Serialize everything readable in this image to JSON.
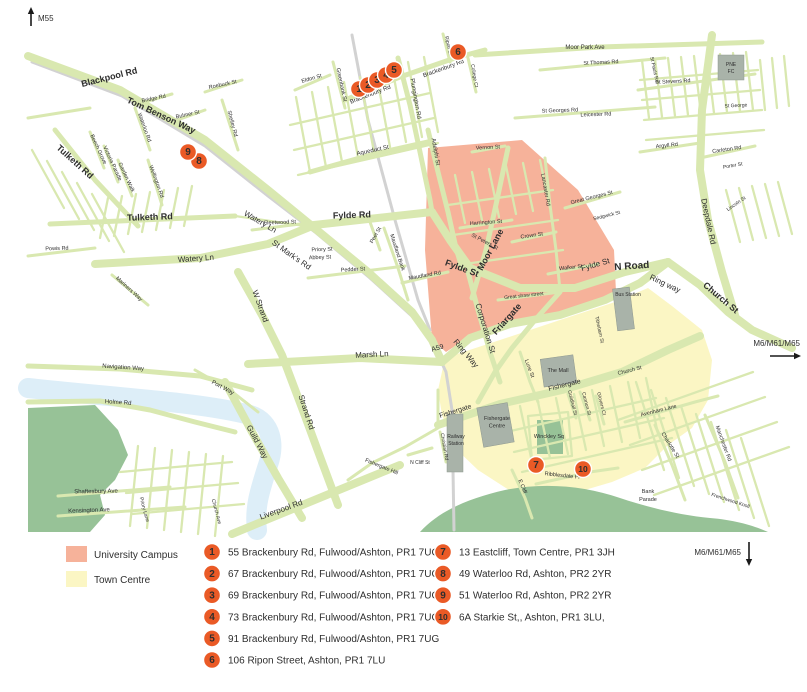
{
  "title": "Preston location map",
  "legend": {
    "swatches": [
      {
        "label": "University Campus",
        "color": "#f6b29a"
      },
      {
        "label": "Town Centre",
        "color": "#fbf6c4"
      }
    ],
    "entries": [
      {
        "num": "1",
        "col": 0,
        "text": "55 Brackenbury Rd, Fulwood/Ashton, PR1 7UG"
      },
      {
        "num": "2",
        "col": 0,
        "text": "67 Brackenbury Rd, Fulwood/Ashton, PR1 7UG"
      },
      {
        "num": "3",
        "col": 0,
        "text": "69 Brackenbury Rd, Fulwood/Ashton, PR1 7UG"
      },
      {
        "num": "4",
        "col": 0,
        "text": "73 Brackenbury Rd, Fulwood/Ashton, PR1 7UG"
      },
      {
        "num": "5",
        "col": 0,
        "text": "91 Brackenbury Rd, Fulwood/Ashton, PR1 7UG"
      },
      {
        "num": "6",
        "col": 0,
        "text": "106 Ripon Street, Ashton, PR1 7LU"
      },
      {
        "num": "7",
        "col": 1,
        "text": "13 Eastcliff, Town Centre, PR1 3JH"
      },
      {
        "num": "8",
        "col": 1,
        "text": "49 Waterloo Rd, Ashton, PR2 2YR"
      },
      {
        "num": "9",
        "col": 1,
        "text": "51 Waterloo Rd, Ashton, PR2 2YR"
      },
      {
        "num": "10",
        "col": 1,
        "text": "6A Starkie St,, Ashton, PR1 3LU,"
      }
    ]
  },
  "motorways": [
    {
      "label": "M55",
      "anchor": "start",
      "tx": 38,
      "ty": 21,
      "arrow": {
        "x1": 31,
        "y1": 26,
        "x2": 31,
        "y2": 7
      }
    },
    {
      "label": "M6/M61/M65",
      "anchor": "end",
      "tx": 800,
      "ty": 346,
      "arrow": {
        "x1": 770,
        "y1": 356,
        "x2": 801,
        "y2": 356
      }
    },
    {
      "label": "M6/M61/M65",
      "anchor": "end",
      "tx": 741,
      "ty": 555,
      "arrow": {
        "x1": 749,
        "y1": 542,
        "x2": 749,
        "y2": 566
      }
    }
  ],
  "map": {
    "marker_color": "#ea5a26",
    "markers": [
      {
        "num": "1",
        "x": 359,
        "y": 89
      },
      {
        "num": "2",
        "x": 368,
        "y": 85
      },
      {
        "num": "3",
        "x": 377,
        "y": 80
      },
      {
        "num": "4",
        "x": 386,
        "y": 75
      },
      {
        "num": "5",
        "x": 394,
        "y": 70
      },
      {
        "num": "6",
        "x": 458,
        "y": 52
      },
      {
        "num": "7",
        "x": 536,
        "y": 465
      },
      {
        "num": "8",
        "x": 199,
        "y": 161
      },
      {
        "num": "9",
        "x": 188,
        "y": 152
      },
      {
        "num": "10",
        "x": 583,
        "y": 469
      }
    ],
    "building_labels": [
      {
        "lines": [
          "PNE",
          "FC"
        ],
        "x": 731,
        "y": 66,
        "s": 5
      },
      {
        "lines": [
          "Bus Station"
        ],
        "x": 628,
        "y": 296,
        "s": 5
      },
      {
        "lines": [
          "The Mall"
        ],
        "x": 558,
        "y": 372,
        "s": 5.5
      },
      {
        "lines": [
          "Fishergate",
          "Centre"
        ],
        "x": 497,
        "y": 420,
        "s": 5.5
      },
      {
        "lines": [
          "Railway",
          "Station"
        ],
        "x": 456,
        "y": 438,
        "s": 5
      }
    ],
    "street_labels": [
      {
        "t": "Blackpool Rd",
        "x": 110,
        "y": 80,
        "r": -14,
        "s": 9
      },
      {
        "t": "Tom Benson Way",
        "x": 160,
        "y": 118,
        "r": 25,
        "s": 9
      },
      {
        "t": "Tulketh Rd",
        "x": 73,
        "y": 164,
        "r": 42,
        "s": 9
      },
      {
        "t": "Tulketh Rd",
        "x": 150,
        "y": 220,
        "r": -2,
        "s": 9
      },
      {
        "t": "Watery Ln",
        "x": 196,
        "y": 261,
        "r": -4,
        "s": 8
      },
      {
        "t": "Watery Ln",
        "x": 259,
        "y": 224,
        "r": 30,
        "s": 8
      },
      {
        "t": "St Mark's Rd",
        "x": 290,
        "y": 257,
        "r": 35,
        "s": 8
      },
      {
        "t": "W Strand",
        "x": 258,
        "y": 307,
        "r": 70,
        "s": 8
      },
      {
        "t": "Strand Rd",
        "x": 304,
        "y": 413,
        "r": 72,
        "s": 8
      },
      {
        "t": "Guild Way",
        "x": 255,
        "y": 443,
        "r": 62,
        "s": 8
      },
      {
        "t": "Liverpool Rd",
        "x": 282,
        "y": 512,
        "r": -20,
        "s": 8
      },
      {
        "t": "Marsh Ln",
        "x": 372,
        "y": 357,
        "r": -3,
        "s": 8
      },
      {
        "t": "A59",
        "x": 438,
        "y": 350,
        "r": -15,
        "s": 7
      },
      {
        "t": "Ring Way",
        "x": 464,
        "y": 355,
        "r": 50,
        "s": 8
      },
      {
        "t": "Ring way",
        "x": 664,
        "y": 286,
        "r": 25,
        "s": 8
      },
      {
        "t": "Fylde Rd",
        "x": 352,
        "y": 218,
        "r": -2,
        "s": 9
      },
      {
        "t": "Fylde St",
        "x": 461,
        "y": 271,
        "r": 20,
        "s": 9
      },
      {
        "t": "Fylde St",
        "x": 596,
        "y": 267,
        "r": -16,
        "s": 8
      },
      {
        "t": "N Road",
        "x": 632,
        "y": 269,
        "r": -4,
        "s": 10
      },
      {
        "t": "Moor Lane",
        "x": 493,
        "y": 251,
        "r": -62,
        "s": 9
      },
      {
        "t": "Corporation St",
        "x": 483,
        "y": 329,
        "r": 73,
        "s": 8
      },
      {
        "t": "Friargate",
        "x": 509,
        "y": 321,
        "r": -48,
        "s": 9
      },
      {
        "t": "Fishergate",
        "x": 456,
        "y": 413,
        "r": -17,
        "s": 7
      },
      {
        "t": "Fishergate",
        "x": 565,
        "y": 387,
        "r": -14,
        "s": 7
      },
      {
        "t": "Church St",
        "x": 719,
        "y": 300,
        "r": 40,
        "s": 9
      },
      {
        "t": "Deepdale Rd",
        "x": 706,
        "y": 222,
        "r": 78,
        "s": 8
      },
      {
        "t": "Powis Rd",
        "x": 57,
        "y": 250,
        "r": -2,
        "s": 5.5
      },
      {
        "t": "Bridge Rd",
        "x": 154,
        "y": 100,
        "r": -12,
        "s": 5.5
      },
      {
        "t": "Bulmer St",
        "x": 188,
        "y": 116,
        "r": -12,
        "s": 5.5
      },
      {
        "t": "Roebuck St",
        "x": 223,
        "y": 86,
        "r": -12,
        "s": 5.5
      },
      {
        "t": "Shelley Rd",
        "x": 231,
        "y": 124,
        "r": 75,
        "s": 5.5
      },
      {
        "t": "Waterloo Rd",
        "x": 143,
        "y": 128,
        "r": 70,
        "s": 5.5
      },
      {
        "t": "Beech Grove",
        "x": 97,
        "y": 150,
        "r": 65,
        "s": 5.5
      },
      {
        "t": "Victoria Parade",
        "x": 111,
        "y": 164,
        "r": 65,
        "s": 5.5
      },
      {
        "t": "Garden Walk",
        "x": 125,
        "y": 178,
        "r": 65,
        "s": 5.5
      },
      {
        "t": "Wellington Rd",
        "x": 155,
        "y": 182,
        "r": 70,
        "s": 5.5
      },
      {
        "t": "Fleetwood St",
        "x": 280,
        "y": 224,
        "r": -2,
        "s": 5.5
      },
      {
        "t": "Priory St",
        "x": 322,
        "y": 251,
        "r": -2,
        "s": 5.5
      },
      {
        "t": "Abbey St",
        "x": 320,
        "y": 259,
        "r": -2,
        "s": 5.5
      },
      {
        "t": "Pedder St",
        "x": 353,
        "y": 271,
        "r": -3,
        "s": 5.5
      },
      {
        "t": "Peel St",
        "x": 377,
        "y": 236,
        "r": -60,
        "s": 5.5
      },
      {
        "t": "Maudland Bank",
        "x": 396,
        "y": 253,
        "r": 72,
        "s": 5.5
      },
      {
        "t": "Maudland Rd",
        "x": 425,
        "y": 277,
        "r": -10,
        "s": 5.5
      },
      {
        "t": "Mariners Way",
        "x": 128,
        "y": 290,
        "r": 42,
        "s": 5.5
      },
      {
        "t": "Navigation Way",
        "x": 123,
        "y": 369,
        "r": 4,
        "s": 6
      },
      {
        "t": "Port Way",
        "x": 222,
        "y": 389,
        "r": 28,
        "s": 6
      },
      {
        "t": "Holme Rd",
        "x": 118,
        "y": 404,
        "r": 4,
        "s": 6
      },
      {
        "t": "Shaftesbury Ave",
        "x": 96,
        "y": 493,
        "r": -1,
        "s": 6
      },
      {
        "t": "Kensington Ave",
        "x": 89,
        "y": 512,
        "r": -2,
        "s": 6
      },
      {
        "t": "Priory Lane",
        "x": 143,
        "y": 510,
        "r": 75,
        "s": 5
      },
      {
        "t": "Church Ave",
        "x": 215,
        "y": 512,
        "r": 75,
        "s": 5
      },
      {
        "t": "Eldon St",
        "x": 312,
        "y": 80,
        "r": -16,
        "s": 5.5
      },
      {
        "t": "Greenbank St",
        "x": 340,
        "y": 85,
        "r": 78,
        "s": 5.5
      },
      {
        "t": "Brackenbury Rd",
        "x": 371,
        "y": 96,
        "r": -21,
        "s": 6
      },
      {
        "t": "Brackenbury Rd",
        "x": 444,
        "y": 70,
        "r": -20,
        "s": 6
      },
      {
        "t": "Plungington Rd",
        "x": 414,
        "y": 99,
        "r": 80,
        "s": 6
      },
      {
        "t": "Aqueduct St",
        "x": 373,
        "y": 152,
        "r": -12,
        "s": 6
      },
      {
        "t": "Adelphi St",
        "x": 434,
        "y": 152,
        "r": 80,
        "s": 6
      },
      {
        "t": "Ripon St",
        "x": 447,
        "y": 46,
        "r": 78,
        "s": 5
      },
      {
        "t": "College Ct",
        "x": 473,
        "y": 76,
        "r": 80,
        "s": 5
      },
      {
        "t": "Moor Park Ave",
        "x": 585,
        "y": 49,
        "r": 0,
        "s": 6
      },
      {
        "t": "St Thomas Rd",
        "x": 601,
        "y": 64,
        "r": -3,
        "s": 5.5
      },
      {
        "t": "St Georges Rd",
        "x": 560,
        "y": 112,
        "r": -2,
        "s": 5.5
      },
      {
        "t": "Leicester Rd",
        "x": 596,
        "y": 116,
        "r": -2,
        "s": 5.5
      },
      {
        "t": "St Stevens Rd",
        "x": 673,
        "y": 83,
        "r": -3,
        "s": 5.5
      },
      {
        "t": "St George",
        "x": 736,
        "y": 107,
        "r": -3,
        "s": 5
      },
      {
        "t": "St Pauls Rd",
        "x": 653,
        "y": 70,
        "r": 78,
        "s": 5
      },
      {
        "t": "Argyll Rd",
        "x": 667,
        "y": 147,
        "r": -6,
        "s": 5.5
      },
      {
        "t": "Carleton Rd",
        "x": 727,
        "y": 151,
        "r": -8,
        "s": 5.5
      },
      {
        "t": "Porter St",
        "x": 733,
        "y": 167,
        "r": -10,
        "s": 5
      },
      {
        "t": "Lincoln St",
        "x": 737,
        "y": 205,
        "r": -35,
        "s": 5
      },
      {
        "t": "Vernon St",
        "x": 488,
        "y": 149,
        "r": -3,
        "s": 5.5
      },
      {
        "t": "Harrington St",
        "x": 486,
        "y": 224,
        "r": -4,
        "s": 5.5
      },
      {
        "t": "St Peters St",
        "x": 484,
        "y": 243,
        "r": 28,
        "s": 5.5
      },
      {
        "t": "Crown St",
        "x": 532,
        "y": 237,
        "r": -8,
        "s": 5.5
      },
      {
        "t": "Walker St",
        "x": 571,
        "y": 269,
        "r": -6,
        "s": 5.5
      },
      {
        "t": "Great shaw street",
        "x": 524,
        "y": 297,
        "r": -6,
        "s": 5
      },
      {
        "t": "Lancaster Rd",
        "x": 544,
        "y": 190,
        "r": 80,
        "s": 5.5
      },
      {
        "t": "Great Georges St",
        "x": 592,
        "y": 199,
        "r": -14,
        "s": 5.5
      },
      {
        "t": "Sedgwick St",
        "x": 607,
        "y": 217,
        "r": -14,
        "s": 5
      },
      {
        "t": "Tithebarn St",
        "x": 598,
        "y": 330,
        "r": 78,
        "s": 5
      },
      {
        "t": "Lune St",
        "x": 528,
        "y": 369,
        "r": 70,
        "s": 5.5
      },
      {
        "t": "Guildhall St",
        "x": 571,
        "y": 403,
        "r": 76,
        "s": 5
      },
      {
        "t": "Cannon St",
        "x": 585,
        "y": 404,
        "r": 76,
        "s": 5
      },
      {
        "t": "Glovers Ct",
        "x": 600,
        "y": 404,
        "r": 76,
        "s": 5
      },
      {
        "t": "Winckley Sq",
        "x": 549,
        "y": 438,
        "r": 0,
        "s": 5.5
      },
      {
        "t": "Church St",
        "x": 630,
        "y": 372,
        "r": -14,
        "s": 5.5
      },
      {
        "t": "Avenham Lane",
        "x": 659,
        "y": 412,
        "r": -14,
        "s": 5.5
      },
      {
        "t": "Charlotte St",
        "x": 669,
        "y": 446,
        "r": 58,
        "s": 5.5
      },
      {
        "t": "Manchester Rd",
        "x": 722,
        "y": 444,
        "r": 70,
        "s": 5.5
      },
      {
        "t": "Bank",
        "x": 648,
        "y": 493,
        "r": 0,
        "s": 5.5
      },
      {
        "t": "Parade",
        "x": 648,
        "y": 501,
        "r": 0,
        "s": 5.5
      },
      {
        "t": "E Cliff",
        "x": 521,
        "y": 487,
        "r": 68,
        "s": 5.5
      },
      {
        "t": "Ribblesdale Pl",
        "x": 562,
        "y": 477,
        "r": 6,
        "s": 5.5
      },
      {
        "t": "Fishergate Hill",
        "x": 381,
        "y": 468,
        "r": 22,
        "s": 5.5
      },
      {
        "t": "N Cliff St",
        "x": 420,
        "y": 464,
        "r": 0,
        "s": 5
      },
      {
        "t": "Christian Rd",
        "x": 443,
        "y": 447,
        "r": 80,
        "s": 5
      },
      {
        "t": "Frenchwood Knoll",
        "x": 730,
        "y": 502,
        "r": 18,
        "s": 5
      }
    ]
  }
}
